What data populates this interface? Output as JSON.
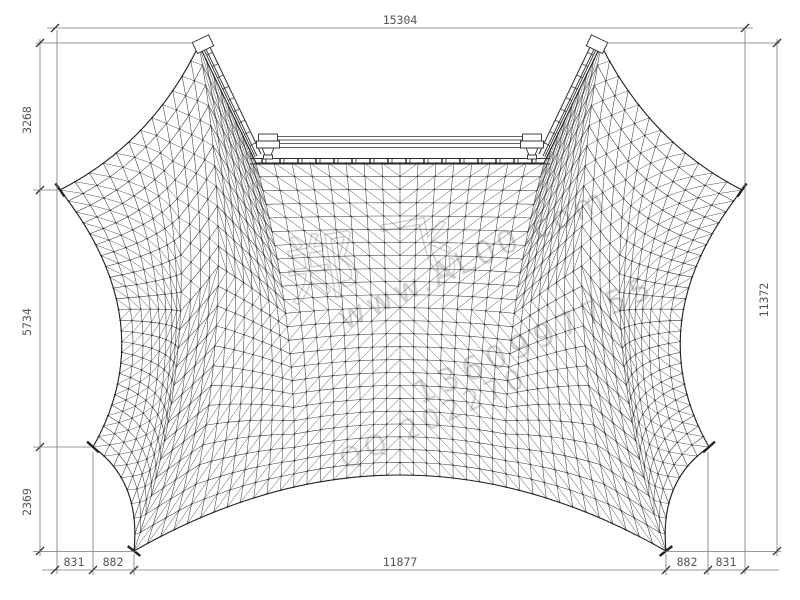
{
  "meta": {
    "background": "#ffffff",
    "mesh_color": "#3a3a3a",
    "outline_color": "#222222",
    "dim_line_color": "#777777",
    "tick_color": "#333333",
    "text_color": "#555555",
    "watermark_color": "#d2d2d2"
  },
  "dimensions": {
    "total_width": "15304",
    "left_top": "3268",
    "left_mid": "5734",
    "left_bottom": "2369",
    "total_height": "11372",
    "bottom": [
      "831",
      "882",
      "11877",
      "882",
      "831"
    ]
  },
  "watermark": {
    "brand": "郑 飞",
    "website": "www.AL00.com",
    "phone": "1360997755",
    "qq": "QQ 202270"
  },
  "drawing": {
    "type": "tensile-membrane-plan-mesh",
    "grid": {
      "cols": 56,
      "rows": 24
    },
    "corners": {
      "left_tip": [
        60,
        190
      ],
      "peak_left": [
        199,
        45
      ],
      "notch_left": [
        256,
        163
      ],
      "notch_right": [
        544,
        163
      ],
      "peak_right": [
        601,
        45
      ],
      "right_tip": [
        742,
        190
      ],
      "right_lower_tip": [
        709,
        447
      ],
      "corner_br": [
        666,
        551
      ],
      "corner_bl": [
        134,
        551
      ],
      "left_lower_tip": [
        93,
        447
      ]
    },
    "edge_controls": {
      "top_left": [
        152,
        143
      ],
      "top_right": [
        650,
        143
      ],
      "left": [
        164,
        322
      ],
      "right": [
        638,
        322
      ],
      "bottom_left": [
        141,
        481
      ],
      "bottom": [
        400,
        399
      ],
      "bottom_right": [
        659,
        481
      ]
    },
    "top_breaks": [
      0.2143,
      0.3571,
      0.6429,
      0.7857
    ],
    "bottom_breaks": [
      0.1429,
      0.8571
    ],
    "diag_flip_center": [
      0.5,
      0.45
    ],
    "beams": {
      "left": {
        "top": [
          199,
          45
        ],
        "base": [
          253,
          158
        ]
      },
      "right": {
        "top": [
          601,
          45
        ],
        "base": [
          547,
          158
        ]
      },
      "offsets": [
        2.5,
        4.5,
        9
      ],
      "rungs": 10
    },
    "track": {
      "x1": 250,
      "x2": 550,
      "y1": 158.5,
      "y2": 164,
      "tick_step": 18
    },
    "header_lines_y": [
      136.5,
      140,
      143.5,
      147.5
    ],
    "header_lines_x": [
      278,
      522
    ],
    "brackets": [
      268,
      532
    ],
    "anchors": [
      {
        "at": [
          60,
          190
        ],
        "angle": 55
      },
      {
        "at": [
          742,
          190
        ],
        "angle": 125
      },
      {
        "at": [
          93,
          447
        ],
        "angle": 42
      },
      {
        "at": [
          709,
          447
        ],
        "angle": 138
      },
      {
        "at": [
          134,
          551
        ],
        "angle": 38
      },
      {
        "at": [
          666,
          551
        ],
        "angle": 142
      }
    ],
    "dim_layout": {
      "top_line": {
        "y": 28,
        "x1": 55,
        "x2": 745
      },
      "left_line": {
        "x": 40,
        "ys": [
          43,
          190,
          447,
          551
        ]
      },
      "right_line": {
        "x": 777,
        "y1": 43,
        "y2": 551
      },
      "bottom_line": {
        "y": 570,
        "xs": [
          55,
          93,
          134,
          666,
          708,
          745
        ]
      }
    }
  }
}
